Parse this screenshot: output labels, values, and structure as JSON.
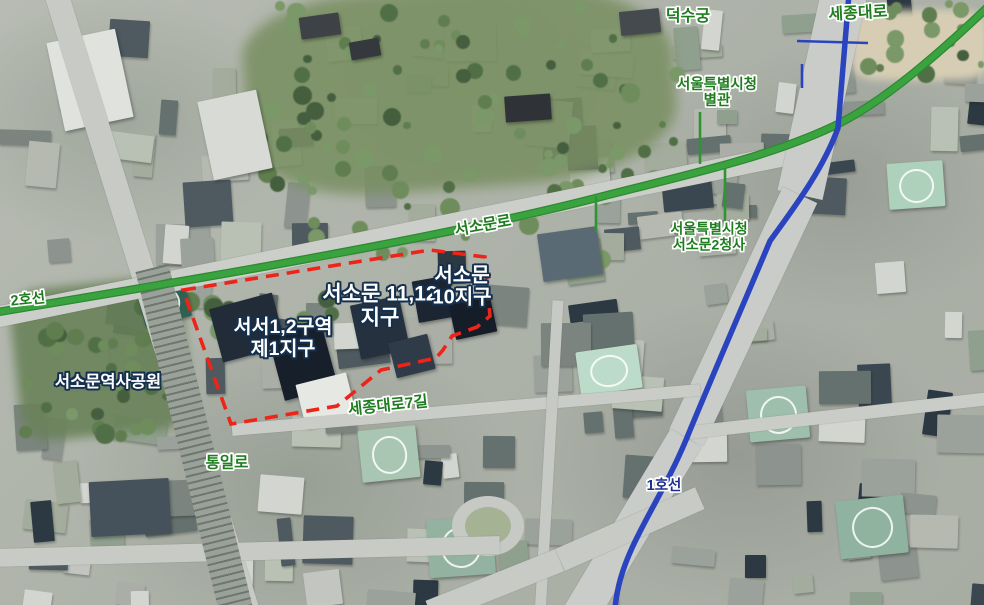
{
  "labels": {
    "deoksugung": "덕수궁",
    "sejongdaero": "세종대로",
    "cityhall_annex_l1": "서울특별시청",
    "cityhall_annex_l2": "별관",
    "seosomunro": "서소문로",
    "subway_line2": "2호선",
    "cityhall_seosomun2_l1": "서울특별시청",
    "cityhall_seosomun2_l2": "서소문2청사",
    "seosomun_history_park": "서소문역사공원",
    "district_seoseo12_l1": "서서1,2구역",
    "district_seoseo12_l2": "제1지구",
    "district_1112_l1": "서소문 11,12",
    "district_1112_l2": "지구",
    "district_10_l1": "서소문",
    "district_10_l2": "10지구",
    "sejongdaero_7gil": "세종대로7길",
    "tongilro": "통일로",
    "subway_line1": "1호선"
  },
  "colors": {
    "subway_line2_green": "#3aa23e",
    "subway_line1_blue": "#2a43be",
    "district_boundary_red": "#ee2418",
    "road_label_green": "#1f7d20",
    "line1_label_blue": "#1f2f8f",
    "district_label_white": "#ffffff",
    "district_label_outline": "#15304e"
  }
}
